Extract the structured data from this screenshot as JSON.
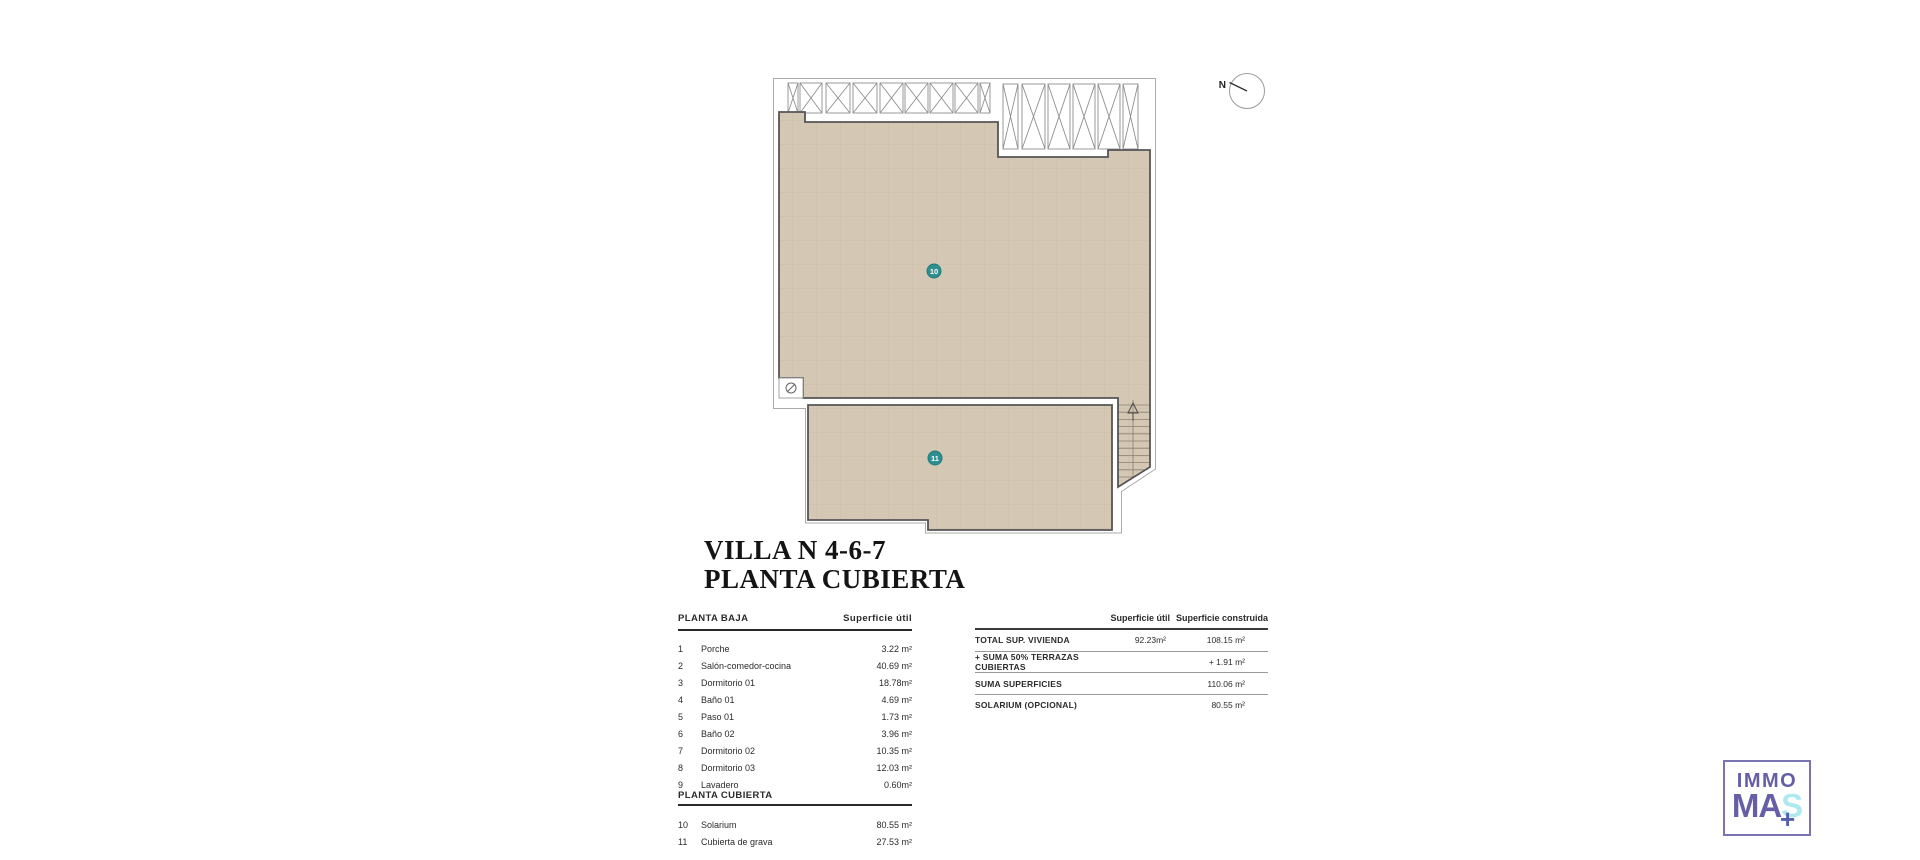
{
  "title": {
    "line1": "VILLA N 4-6-7",
    "line2": "PLANTA CUBIERTA"
  },
  "compass": {
    "label": "N"
  },
  "plan": {
    "markers": [
      {
        "label": "10",
        "room": "Solarium"
      },
      {
        "label": "11",
        "room": "Cubierta de grava"
      }
    ],
    "colors": {
      "floor": "#d4c7b4",
      "grid": "#c0b09a",
      "outline": "#555555",
      "outer_line": "#ababab",
      "marker": "#2f8e8e"
    }
  },
  "areas_table": {
    "sections": [
      {
        "header": "PLANTA BAJA",
        "value_header": "Superficie útil",
        "rows": [
          {
            "num": "1",
            "label": "Porche",
            "value": "3.22 m²"
          },
          {
            "num": "2",
            "label": "Salón-comedor-cocina",
            "value": "40.69 m²"
          },
          {
            "num": "3",
            "label": "Dormitorio 01",
            "value": "18.78m²"
          },
          {
            "num": "4",
            "label": "Baño 01",
            "value": "4.69 m²"
          },
          {
            "num": "5",
            "label": "Paso 01",
            "value": "1.73 m²"
          },
          {
            "num": "6",
            "label": "Baño 02",
            "value": "3.96 m²"
          },
          {
            "num": "7",
            "label": "Dormitorio 02",
            "value": "10.35 m²"
          },
          {
            "num": "8",
            "label": "Dormitorio 03",
            "value": "12.03 m²"
          },
          {
            "num": "9",
            "label": "Lavadero",
            "value": "0.60m²"
          }
        ]
      },
      {
        "header": "PLANTA CUBIERTA",
        "rows": [
          {
            "num": "10",
            "label": "Solarium",
            "value": "80.55 m²"
          },
          {
            "num": "11",
            "label": "Cubierta de grava",
            "value": "27.53 m²"
          }
        ]
      }
    ]
  },
  "summary_table": {
    "col1_header": "Superficie útil",
    "col2_header": "Superficie construida",
    "rows": [
      {
        "label": "TOTAL SUP. VIVIENDA",
        "util": "92.23m²",
        "construida": "108.15 m²"
      },
      {
        "label": "+ SUMA 50% TERRAZAS CUBIERTAS",
        "util": "",
        "construida": "+ 1.91 m²"
      },
      {
        "label": "SUMA SUPERFICIES",
        "util": "",
        "construida": "110.06 m²"
      },
      {
        "label": "SOLARIUM (OPCIONAL)",
        "util": "",
        "construida": "80.55 m²"
      }
    ]
  },
  "logo": {
    "line1": "IMMO",
    "line2_part1": "MA",
    "line2_part2": "S",
    "plus": "+",
    "colors": {
      "purple": "#665fa7",
      "cyan": "#aee9f1",
      "plus": "#5560a8",
      "border": "#7b74b2"
    }
  }
}
